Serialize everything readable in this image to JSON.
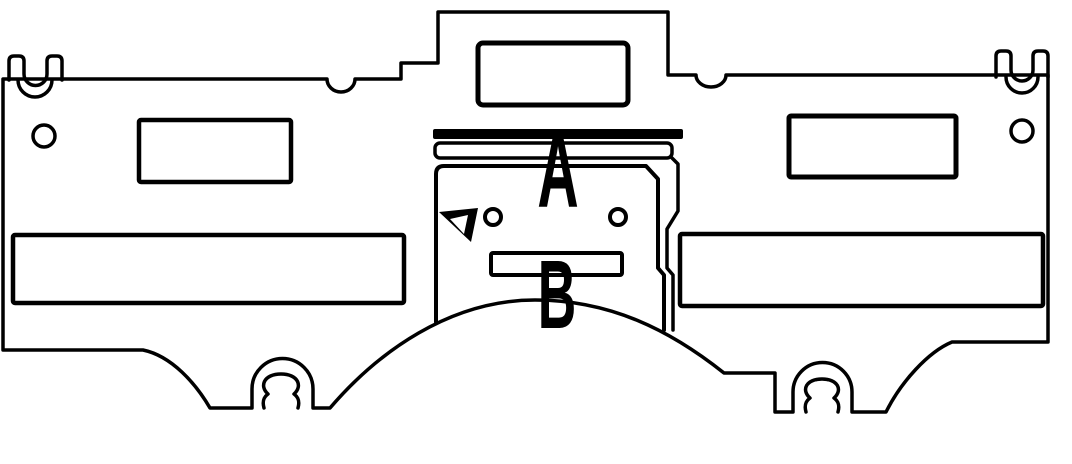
{
  "figure": {
    "kind": "technical-line-drawing",
    "subject": "stamped sheet-metal panel with callout letters",
    "ink_color": "#000000",
    "background_color": "#ffffff"
  },
  "labels": {
    "a": "A",
    "b": "B"
  }
}
